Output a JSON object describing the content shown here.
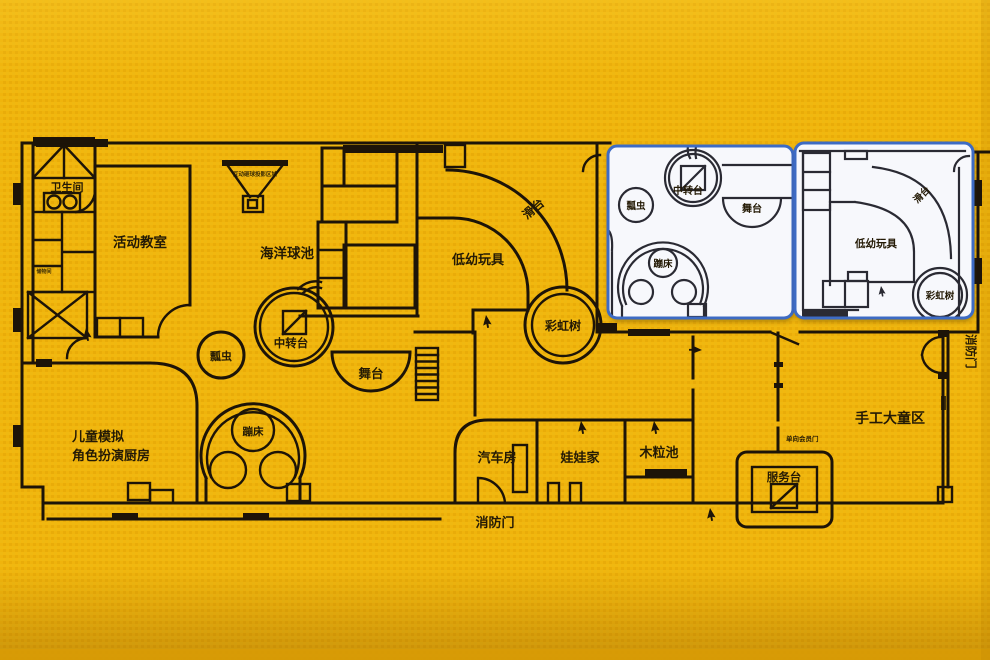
{
  "colors": {
    "background": "#F0B40C",
    "background_edge": "#D89B06",
    "wall": "#1D1408",
    "label": "#241A05",
    "inset_background": "#F7F8FC",
    "inset_border": "#3D6BC4"
  },
  "plan": {
    "labels": {
      "bathroom": "卫生间",
      "storage": "储物间",
      "projection": "互动砸球投影区域",
      "activity_room": "活动教室",
      "ball_pool": "海洋球池",
      "transfer_station": "中转台",
      "ladybug": "瓢虫",
      "stage": "舞台",
      "slide": "滑台",
      "toddler_toys": "低幼玩具",
      "rainbow_tree": "彩虹树",
      "trampoline": "蹦床",
      "kitchen_line1": "儿童模拟",
      "kitchen_line2": "角色扮演厨房",
      "car_room": "汽车房",
      "doll_house": "娃娃家",
      "wood_chip_pool": "木粒池",
      "service_desk": "服务台",
      "one_way_member_door": "单向会员门",
      "craft_kids_area": "手工大童区",
      "fire_door_bottom": "消防门",
      "fire_door_right": "消防门"
    }
  },
  "inset_left": {
    "labels": {
      "transfer_station": "中转台",
      "ladybug": "瓢虫",
      "stage": "舞台",
      "trampoline": "蹦床"
    }
  },
  "inset_right": {
    "labels": {
      "slide": "滑台",
      "toddler_toys": "低幼玩具",
      "rainbow_tree": "彩虹树"
    }
  }
}
